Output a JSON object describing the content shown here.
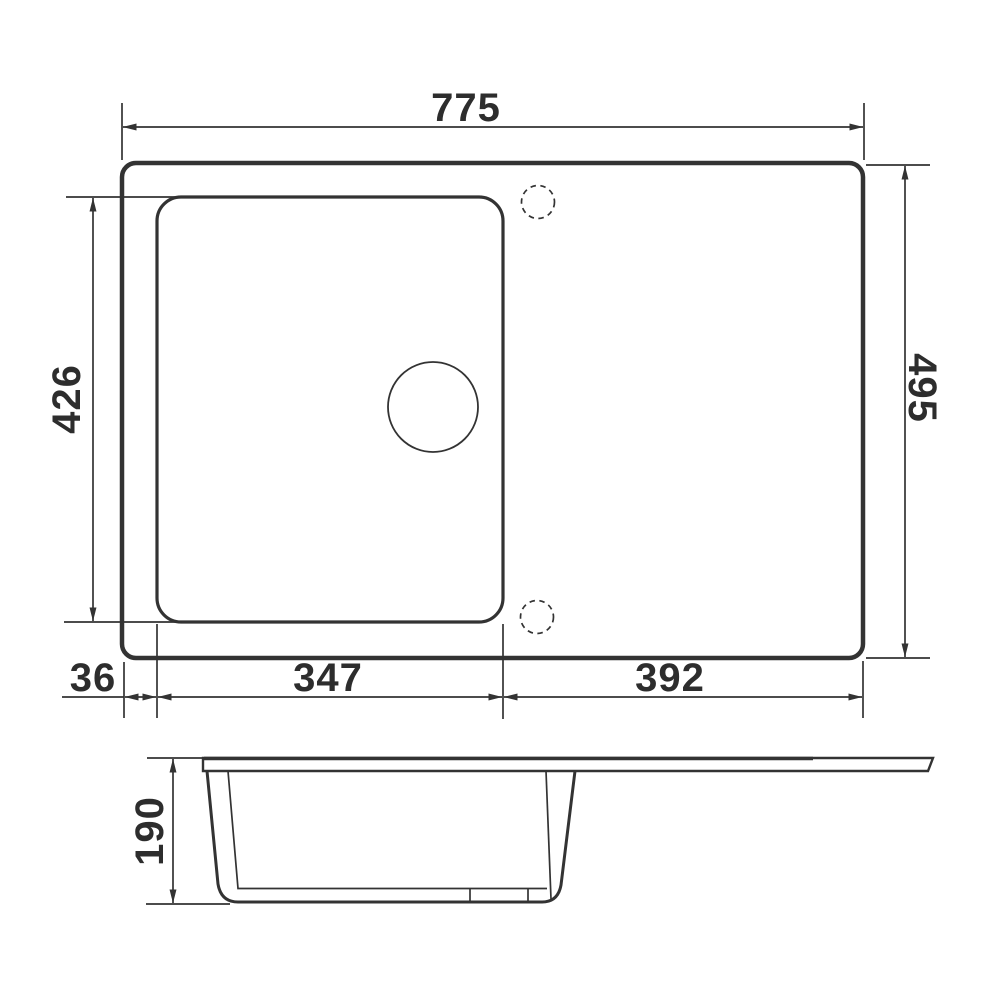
{
  "colors": {
    "line": "#333333",
    "text": "#2d2d2d",
    "background": "#ffffff"
  },
  "dimensions": {
    "overall_width": "775",
    "overall_depth": "495",
    "bowl_depth": "426",
    "bowl_left_offset": "36",
    "bowl_width": "347",
    "drainboard_width": "392",
    "bowl_height": "190"
  }
}
